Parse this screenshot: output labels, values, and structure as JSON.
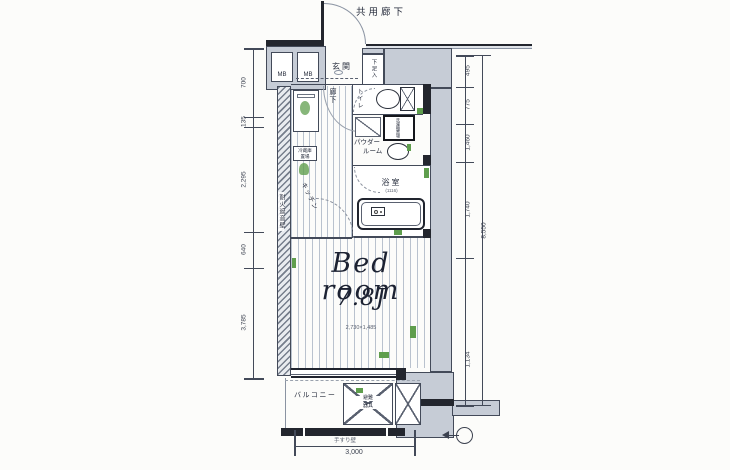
{
  "colors": {
    "background": "#fcfcfa",
    "wall_fill": "#c6ccd6",
    "outline": "#434a59",
    "ink_dark": "#23262e",
    "floor_line": "#b9c2ce",
    "accent_green": "#5f9e4d",
    "text": "#262c3c",
    "dim_text": "#3c4250"
  },
  "plan": {
    "common_corridor": "共用廊下",
    "entrance": "玄関",
    "shoe_cabinet": "下足入",
    "meter_box": "MB",
    "hallway": "廊下",
    "toilet": "トイレ",
    "washer": "洗濯機置場",
    "powder_room_line1": "パウダー",
    "powder_room_line2": "ルーム",
    "bathroom": "浴室",
    "bathroom_size": "(1116)",
    "fridge_line1": "冷蔵庫",
    "fridge_line2": "置場",
    "kitchen": "キッチン",
    "fire_wall": "耐火遮音壁",
    "bedroom_name": "Bed room",
    "bedroom_size": "7.8J",
    "bedroom_note": "2,730×1,485",
    "balcony": "バルコニー",
    "escape_hatch_line1": "避難",
    "escape_hatch_line2": "器具",
    "balcony_note": "手すり壁"
  },
  "dimensions": {
    "left": [
      "700",
      "135",
      "2,295",
      "640",
      "3,785"
    ],
    "right": [
      "495",
      "775",
      "1,460",
      "1,740",
      "1,134"
    ],
    "right_total": "8,550",
    "bottom": "3,000"
  }
}
